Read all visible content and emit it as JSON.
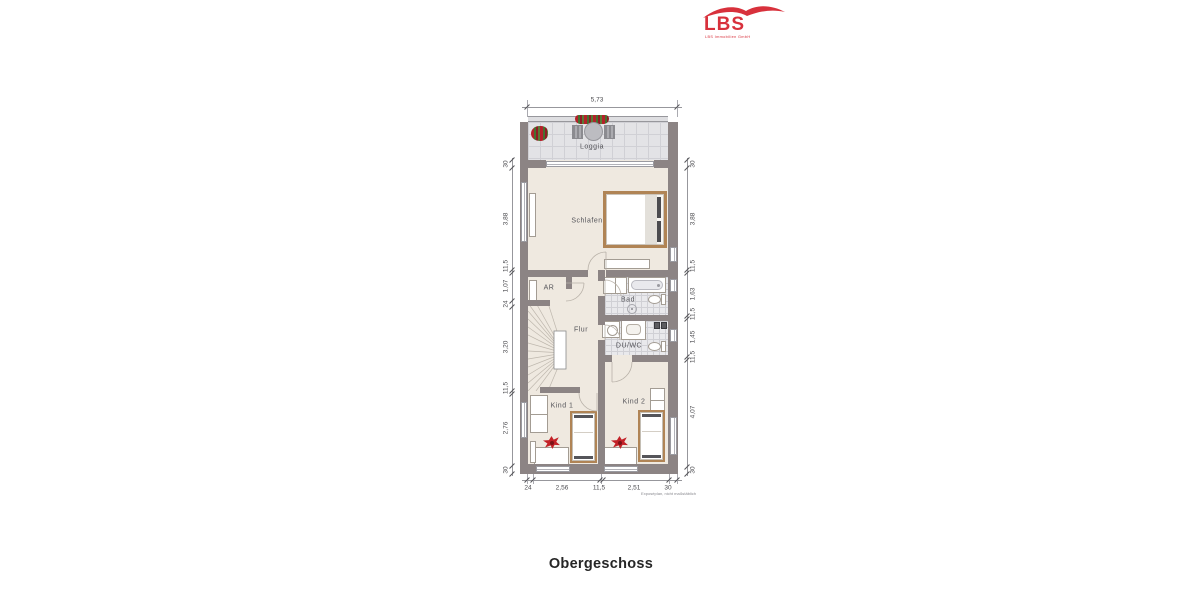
{
  "logo": {
    "name": "LBS",
    "tagline": "LBS Immobilien GmbH"
  },
  "floor_title": "Obergeschoss",
  "disclaimer": "Exposéplan, nicht maßstäblich",
  "rooms": {
    "loggia": "Loggia",
    "schlafen": "Schlafen",
    "ar": "AR",
    "flur": "Flur",
    "bad": "Bad",
    "duwc": "DU/WC",
    "kind1": "Kind 1",
    "kind2": "Kind 2"
  },
  "dimensions": {
    "top": [
      "5,73"
    ],
    "left": [
      "30",
      "3,88",
      "11,5",
      "1,07",
      "24",
      "3,20",
      "11,5",
      "2,76",
      "30"
    ],
    "right": [
      "30",
      "3,88",
      "11,5",
      "1,63",
      "11,5",
      "1,45",
      "11,5",
      "4,07",
      "30"
    ],
    "bottom": [
      "24",
      "2,56",
      "11,5",
      "2,51",
      "30"
    ]
  },
  "colors": {
    "wall": "#8c8484",
    "floor": "#efe9e0",
    "tile": "#e3e3e6",
    "wood": "#b08455",
    "accent_red": "#c32127",
    "logo_red": "#d8313c"
  }
}
